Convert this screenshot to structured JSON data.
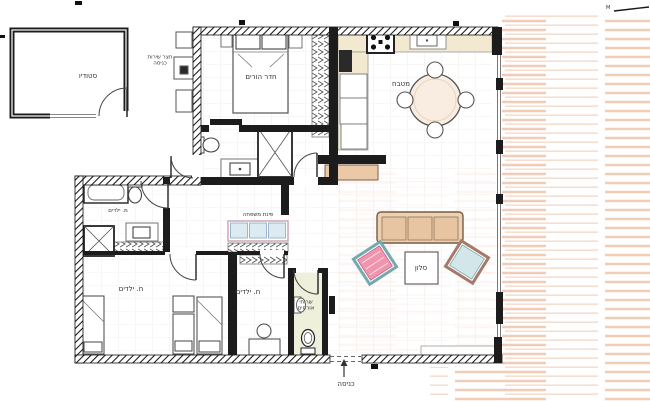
{
  "labels": {
    "studio": "סטודיו",
    "service_yard_line1": "חצר שירות",
    "service_yard_line2": "כניסה",
    "master_bedroom": "חדר הורים",
    "kitchen": "מטבח",
    "family_corner": "פינת משפחה",
    "kids_bathroom": "מ. ילדים",
    "kids_room_1": "ח. ילדים",
    "kids_room_2": "ח. ילדים",
    "guest_wc_line1": "שרותי",
    "guest_wc_line2": "אורחים",
    "living_room": "סלון",
    "entrance": "כניסה",
    "scale_mark": "M"
  },
  "colors": {
    "wall": "#1c1c1c",
    "ink": "#333333",
    "counter": "#f3e9d0",
    "sofa_body": "#ecd2b4",
    "sofa_cushion": "#e7c5a2",
    "sofa_edge": "#7a5a42",
    "armchair_pink": "#f194ae",
    "armchair_pink_edge": "#74a9b2",
    "armchair_blue": "#d3e6e9",
    "armchair_blue_edge": "#a5796b",
    "family_cushion": "#dcebf2",
    "family_edge": "#c99aae",
    "deck1": "#efc3ac",
    "deck2": "#f6d9c8",
    "wc_floor": "#eef0db",
    "sideboard": "#ecc9a6",
    "table_wash": "#f9ece0"
  }
}
